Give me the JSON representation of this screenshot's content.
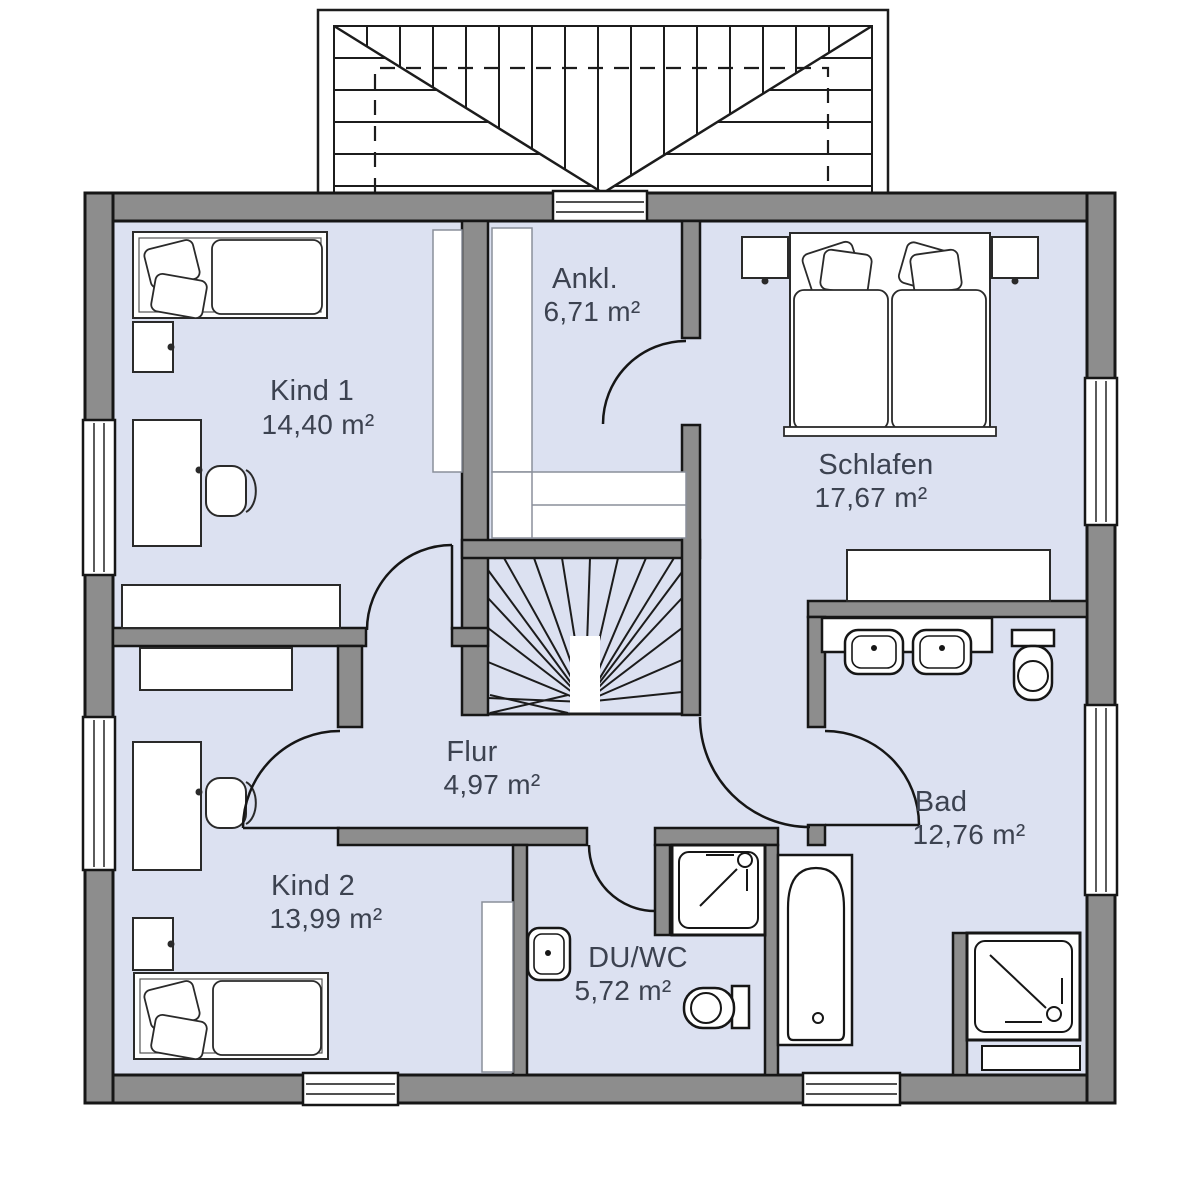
{
  "plan": {
    "type": "floor-plan",
    "rooms": [
      {
        "id": "kind1",
        "name": "Kind 1",
        "area": "14,40 m²"
      },
      {
        "id": "ankl",
        "name": "Ankl.",
        "area": "6,71 m²"
      },
      {
        "id": "schlafen",
        "name": "Schlafen",
        "area": "17,67 m²"
      },
      {
        "id": "flur",
        "name": "Flur",
        "area": "4,97 m²"
      },
      {
        "id": "kind2",
        "name": "Kind 2",
        "area": "13,99 m²"
      },
      {
        "id": "duwc",
        "name": "DU/WC",
        "area": "5,72 m²"
      },
      {
        "id": "bad",
        "name": "Bad",
        "area": "12,76 m²"
      }
    ],
    "colors": {
      "room_fill": "#dce1f1",
      "wall_fill": "#8d8d8d",
      "outline": "#161616",
      "label_text": "#3c4250",
      "background": "#ffffff"
    }
  }
}
